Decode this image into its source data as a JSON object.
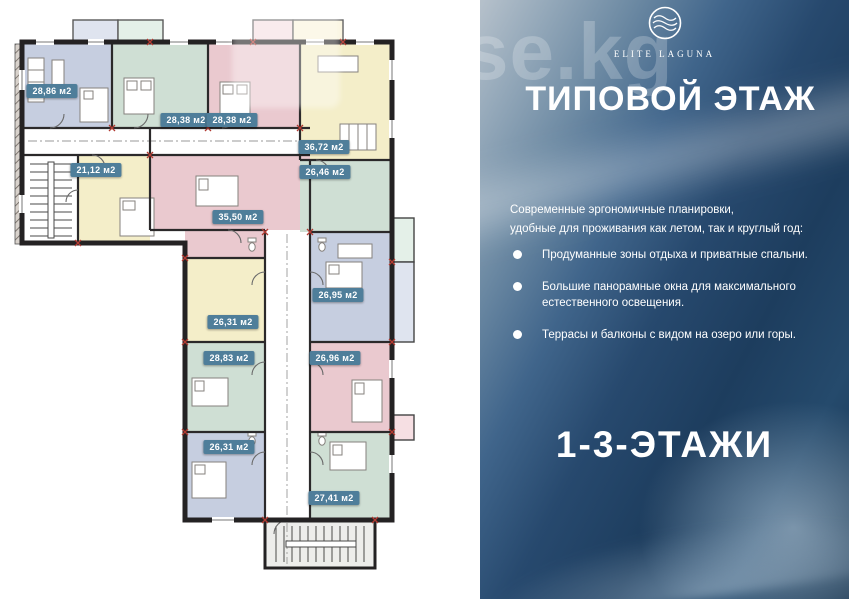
{
  "watermark": "se.kg",
  "plan": {
    "badge_bg": "#4f7e9a",
    "badge_text": "#ffffff",
    "palette": {
      "blue": "#c6cee0",
      "green": "#cfdfd4",
      "pink": "#eac9cf",
      "yellow": "#f4eec9",
      "blue_l": "#dfe4ef",
      "green_l": "#e4f0e8",
      "pink_l": "#f6dfe3",
      "yellow_l": "#faf4dc"
    },
    "units": [
      {
        "label": "28,86 м2",
        "x": 52,
        "y": 91,
        "color_key": "blue"
      },
      {
        "label": "28,38 м2",
        "x": 186,
        "y": 120,
        "color_key": "green"
      },
      {
        "label": "28,38 м2",
        "x": 232,
        "y": 120,
        "color_key": "pink"
      },
      {
        "label": "36,72 м2",
        "x": 324,
        "y": 147,
        "color_key": "yellow"
      },
      {
        "label": "26,46 м2",
        "x": 325,
        "y": 172,
        "color_key": "green"
      },
      {
        "label": "21,12 м2",
        "x": 96,
        "y": 170,
        "color_key": "yellow"
      },
      {
        "label": "35,50 м2",
        "x": 238,
        "y": 217,
        "color_key": "pink"
      },
      {
        "label": "26,95 м2",
        "x": 338,
        "y": 295,
        "color_key": "blue"
      },
      {
        "label": "26,31 м2",
        "x": 233,
        "y": 322,
        "color_key": "yellow"
      },
      {
        "label": "28,83 м2",
        "x": 229,
        "y": 358,
        "color_key": "green"
      },
      {
        "label": "26,96 м2",
        "x": 335,
        "y": 358,
        "color_key": "pink"
      },
      {
        "label": "26,31 м2",
        "x": 229,
        "y": 447,
        "color_key": "blue"
      },
      {
        "label": "27,41 м2",
        "x": 334,
        "y": 498,
        "color_key": "green"
      }
    ]
  },
  "panel": {
    "logo_brand": "ELITE LAGUNA",
    "title": "ТИПОВОЙ ЭТАЖ",
    "intro_line1": "Современные эргономичные планировки,",
    "intro_line2": "удобные для проживания как летом, так и круглый год:",
    "bullets": [
      "Продуманные зоны отдыха и приватные спальни.",
      "Большие панорамные окна для максимального естественного освещения.",
      "Террасы и балконы с видом на озеро или горы."
    ],
    "floors_label": "1-3-ЭТАЖИ"
  }
}
